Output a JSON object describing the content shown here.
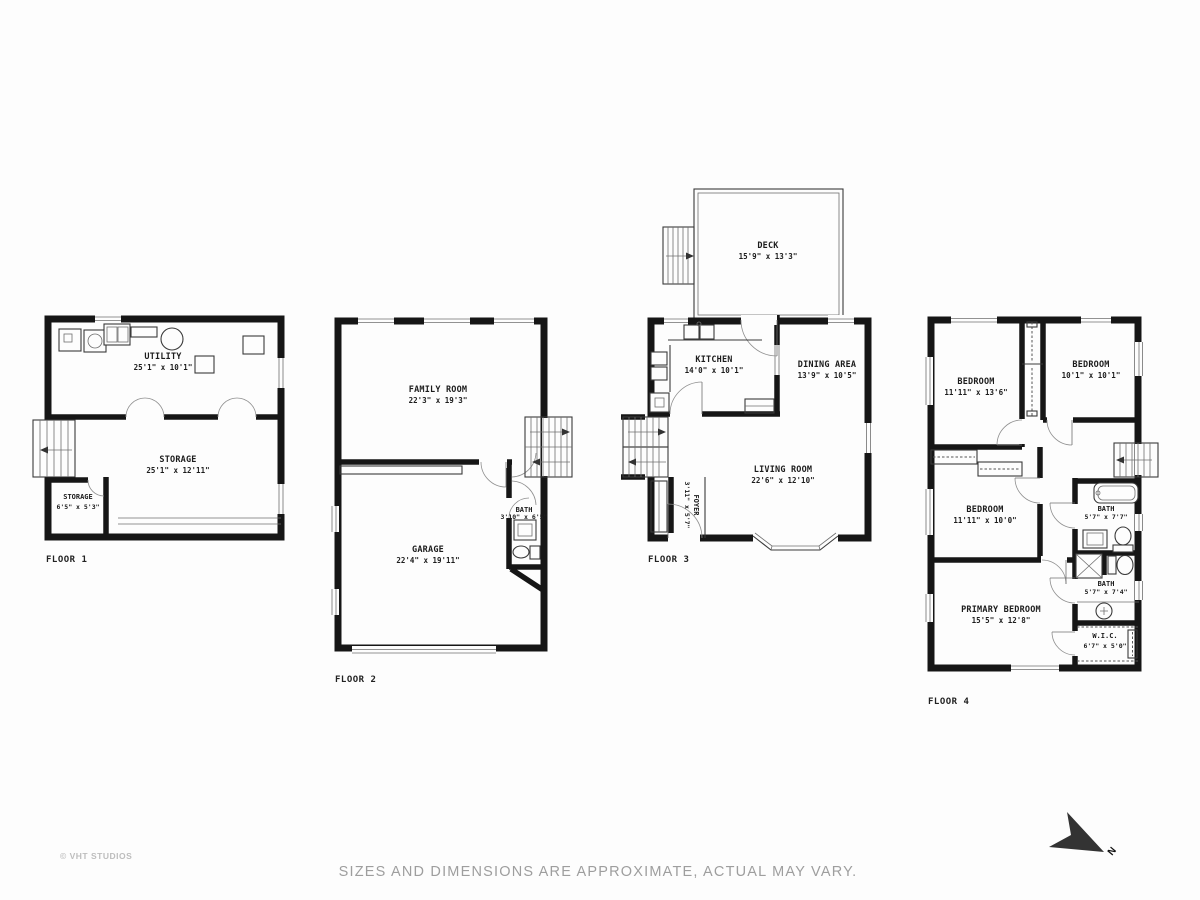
{
  "floors": [
    {
      "label": "FLOOR 1",
      "rooms": [
        {
          "name": "UTILITY",
          "dims": "25'1\" x 10'1\""
        },
        {
          "name": "STORAGE",
          "dims": "25'1\" x 12'11\""
        },
        {
          "name": "STORAGE",
          "dims": "6'5\" x 5'3\""
        }
      ]
    },
    {
      "label": "FLOOR 2",
      "rooms": [
        {
          "name": "FAMILY ROOM",
          "dims": "22'3\" x 19'3\""
        },
        {
          "name": "GARAGE",
          "dims": "22'4\" x 19'11\""
        },
        {
          "name": "BATH",
          "dims": "3'10\" x 6'5\""
        }
      ]
    },
    {
      "label": "FLOOR 3",
      "rooms": [
        {
          "name": "DECK",
          "dims": "15'9\" x 13'3\""
        },
        {
          "name": "KITCHEN",
          "dims": "14'0\" x 10'1\""
        },
        {
          "name": "DINING AREA",
          "dims": "13'9\" x 10'5\""
        },
        {
          "name": "LIVING ROOM",
          "dims": "22'6\" x 12'10\""
        },
        {
          "name": "FOYER",
          "dims": "3'11\" x 5'7\""
        }
      ]
    },
    {
      "label": "FLOOR 4",
      "rooms": [
        {
          "name": "BEDROOM",
          "dims": "11'11\" x 13'6\""
        },
        {
          "name": "BEDROOM",
          "dims": "10'1\" x 10'1\""
        },
        {
          "name": "BEDROOM",
          "dims": "11'11\" x 10'0\""
        },
        {
          "name": "BATH",
          "dims": "5'7\" x 7'7\""
        },
        {
          "name": "BATH",
          "dims": "5'7\" x 7'4\""
        },
        {
          "name": "PRIMARY BEDROOM",
          "dims": "15'5\" x 12'8\""
        },
        {
          "name": "W.I.C.",
          "dims": "6'7\" x 5'0\""
        }
      ]
    }
  ],
  "footer": {
    "copyright": "© VHT STUDIOS",
    "disclaimer": "SIZES AND DIMENSIONS ARE APPROXIMATE, ACTUAL MAY VARY."
  },
  "compass": {
    "label": "N"
  },
  "colors": {
    "wall": "#161616",
    "text": "#1c1c1c",
    "muted": "#9e9e9e"
  }
}
